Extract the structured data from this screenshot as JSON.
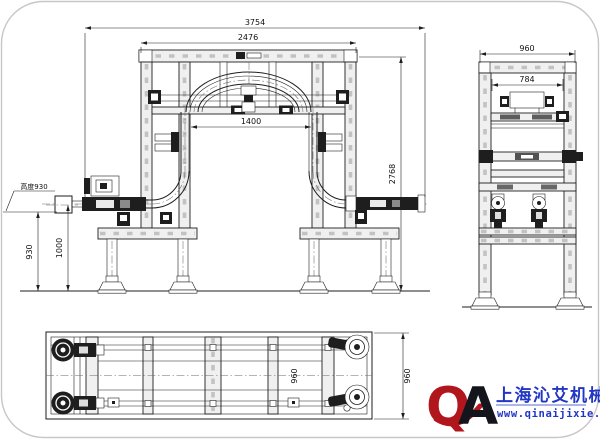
{
  "page": {
    "background": "#ffffff",
    "border_color": "#c7c7c7"
  },
  "drawing": {
    "line_color": "#1e1e1e",
    "front_view": {
      "dims": {
        "overall_width": "3754",
        "frame_width": "2476",
        "opening_width": "1400",
        "overall_height": "2768",
        "infeed_height": "930",
        "conveyor_height": "1000",
        "height_callout": "高度930"
      }
    },
    "side_view": {
      "dims": {
        "overall_width": "960",
        "inner_width": "784"
      }
    },
    "plan_view": {
      "dims": {
        "overall_depth": "960",
        "inner_depth_label": "960"
      }
    }
  },
  "logo": {
    "monogram": {
      "q": "Q",
      "a": "A"
    },
    "company": "上海沁艾机械",
    "website": "www.qinaijixie.com",
    "colors": {
      "red": "#b2161d",
      "blue": "#2236c4"
    }
  }
}
